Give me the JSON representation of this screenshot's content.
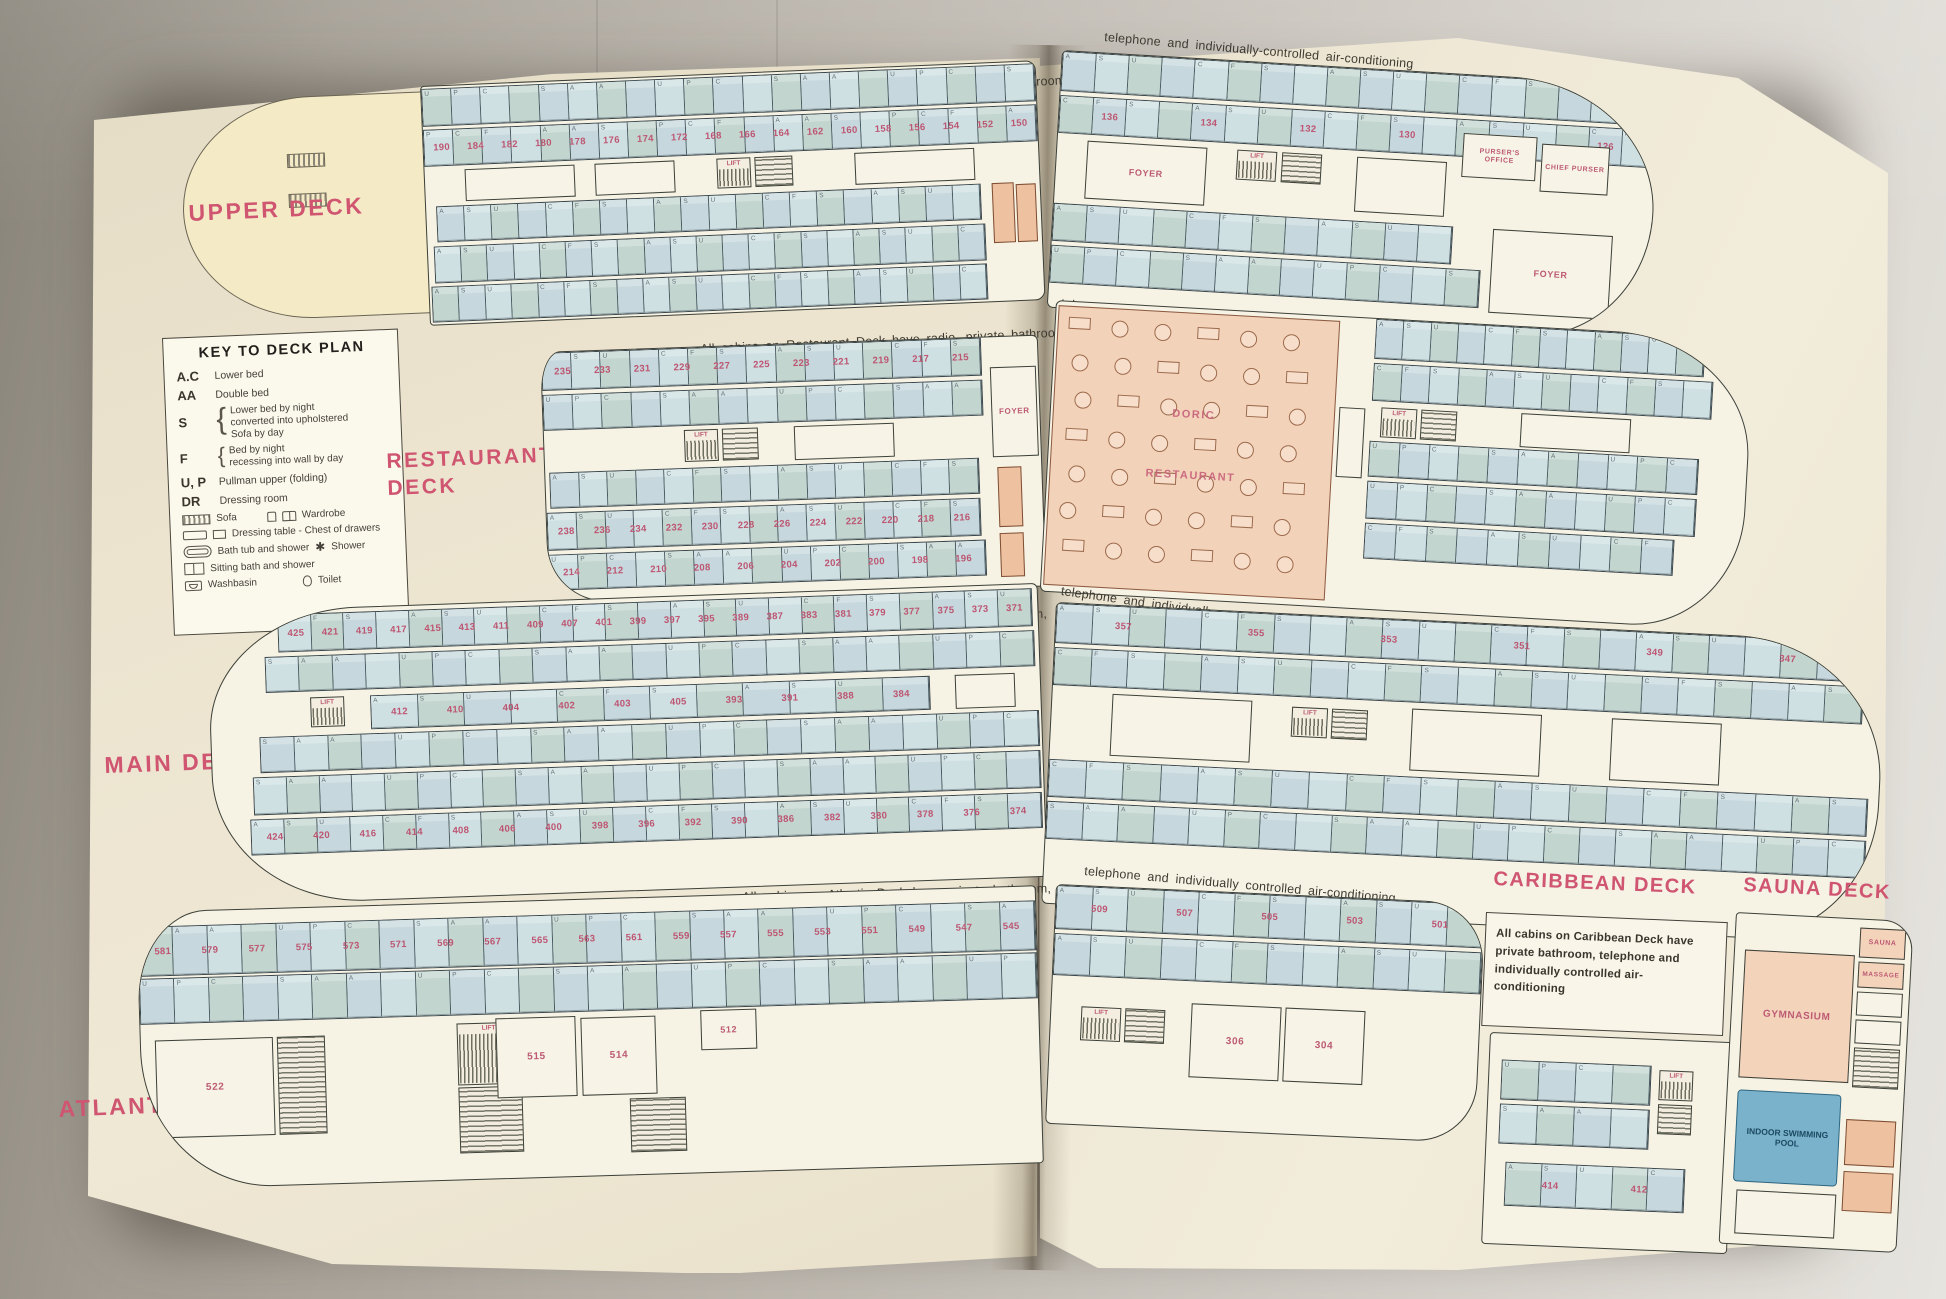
{
  "photo": {
    "backdrop": "#b4aea6",
    "paper": "#ece4cf",
    "accent_pink": "#cf5570",
    "cabin_blue": "#c8dade",
    "restaurant_peach": "#f3d2ba",
    "pool_blue": "#79b2ca"
  },
  "lift_label": "LIFT",
  "cabin_codes": [
    "A",
    "S",
    "U",
    "P",
    "C",
    "F",
    "S",
    "A"
  ],
  "legend": {
    "title": "KEY TO DECK PLAN",
    "entries": [
      {
        "code": "A.C",
        "desc": "Lower bed"
      },
      {
        "code": "AA",
        "desc": "Double bed"
      },
      {
        "code": "S",
        "lines": [
          "Lower bed by night",
          "converted into upholstered",
          "Sofa by day"
        ]
      },
      {
        "code": "F",
        "lines": [
          "Bed by night",
          "recessing into wall by day"
        ]
      },
      {
        "code": "U, P",
        "desc": "Pullman upper (folding)"
      },
      {
        "code": "DR",
        "desc": "Dressing room"
      }
    ],
    "icons": {
      "sofa": "Sofa",
      "wardrobe": "Wardrobe",
      "dressing": "Dressing table - Chest of drawers",
      "bath": "Bath tub and shower",
      "shower": "Shower",
      "sitting": "Sitting bath and shower",
      "washbasin": "Washbasin",
      "toilet": "Toilet"
    }
  },
  "decks": {
    "upper": {
      "label": "UPPER DECK",
      "caption_left": "All cabins on Upper Deck have radio, private bathroom,",
      "caption_right": "telephone and individually-controlled air-conditioning",
      "left_numbers": [
        "190",
        "184",
        "182",
        "180",
        "178",
        "176",
        "174",
        "172",
        "168",
        "166",
        "164",
        "162",
        "160",
        "158",
        "156",
        "154",
        "152",
        "150"
      ],
      "right_numbers": [
        "136",
        "134",
        "132",
        "130",
        "128",
        "126"
      ],
      "rooms": {
        "foyer": "FOYER",
        "pursers_office": "PURSER'S OFFICE",
        "chief_purser": "CHIEF PURSER"
      }
    },
    "restaurant": {
      "label_lines": [
        "RESTAURANT",
        "DECK"
      ],
      "caption_left": "All cabins on Restaurant Deck have radio, private bathroom,",
      "caption_right": "telephone and individually-controlled air-conditioning",
      "foyer": "FOYER",
      "restaurant_name_lines": [
        "DORIC",
        "RESTAURANT"
      ],
      "numbers_top": [
        "235",
        "233",
        "231",
        "229",
        "227",
        "225",
        "223",
        "221",
        "219",
        "217",
        "215"
      ],
      "numbers_mid": [
        "238",
        "236",
        "234",
        "232",
        "230",
        "228",
        "226",
        "224",
        "222",
        "220",
        "218",
        "216"
      ],
      "numbers_bottom": [
        "214",
        "212",
        "210",
        "208",
        "206",
        "204",
        "202",
        "200",
        "198",
        "196"
      ]
    },
    "main": {
      "label": "MAIN DECK",
      "caption_left": "All cabins on Main Deck have private bathroom,",
      "caption_right": "telephone and individually-controlled air-conditioning",
      "numbers_top": [
        "425",
        "421",
        "419",
        "417",
        "415",
        "413",
        "411",
        "409",
        "407",
        "401",
        "399",
        "397",
        "395",
        "389",
        "387",
        "383",
        "381",
        "379",
        "377",
        "375",
        "373",
        "371"
      ],
      "numbers_mid": [
        "412",
        "410",
        "404",
        "402",
        "403",
        "405",
        "393",
        "391",
        "388",
        "384"
      ],
      "numbers_bottom": [
        "424",
        "420",
        "416",
        "414",
        "408",
        "406",
        "400",
        "398",
        "396",
        "392",
        "390",
        "386",
        "382",
        "380",
        "378",
        "376",
        "374"
      ],
      "right_numbers": [
        "357",
        "355",
        "353",
        "351",
        "349",
        "347"
      ]
    },
    "atlantic": {
      "label": "ATLANTIC DECK",
      "caption_left": "All cabins on Atlantic Deck have private bathroom,",
      "caption_right": "telephone and individually controlled air-conditioning.",
      "numbers_top": [
        "581",
        "579",
        "577",
        "575",
        "573",
        "571",
        "569",
        "567",
        "565",
        "563",
        "561",
        "559",
        "557",
        "555",
        "553",
        "551",
        "549",
        "547",
        "545"
      ],
      "room_numbers": [
        "522",
        "515",
        "514",
        "512"
      ],
      "right_numbers": [
        "509",
        "507",
        "505",
        "503",
        "501"
      ],
      "right_room_numbers": [
        "306",
        "304"
      ]
    },
    "caribbean": {
      "label": "CARIBBEAN DECK",
      "note": "All cabins on Caribbean Deck have private bathroom, telephone and individually controlled air-conditioning",
      "numbers": [
        "414",
        "412"
      ]
    },
    "sauna": {
      "label": "SAUNA DECK",
      "gym": "GYMNASIUM",
      "sauna": "SAUNA",
      "massage": "MASSAGE",
      "pool": "INDOOR SWIMMING POOL"
    }
  }
}
